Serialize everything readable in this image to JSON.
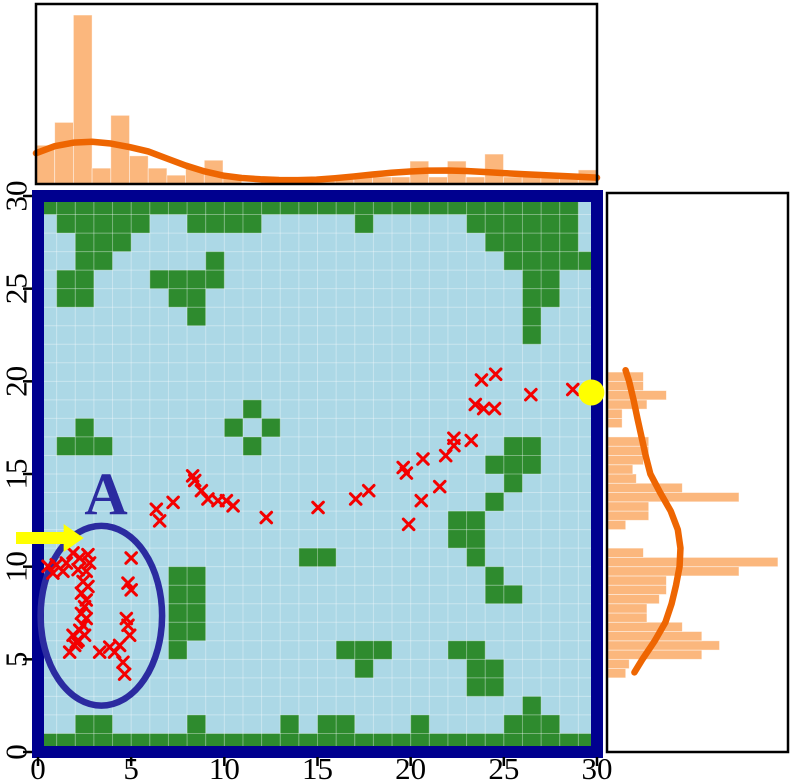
{
  "colors": {
    "background_free": "#ACD8E6",
    "obstacle_green": "#2E8B2E",
    "border_navy": "#00008F",
    "annotation_blue": "#2B2BA0",
    "trajectory_red": "#F40000",
    "start_goal_yellow": "#FFFF00",
    "hist_bar_orange": "#FBB77D",
    "kde_orange": "#EE6602",
    "frame_black": "#000000",
    "grid_seam": "rgba(255,255,255,0.35)",
    "tick_text": "#000000"
  },
  "main_plot": {
    "region_label": "A",
    "x_tick_values": [
      0,
      5,
      10,
      15,
      20,
      25,
      30
    ],
    "x_tick_labels": [
      "0",
      "5",
      "10",
      "15",
      "20",
      "25",
      "30"
    ],
    "y_tick_values": [
      0,
      5,
      10,
      15,
      20,
      25,
      30
    ],
    "y_tick_labels": [
      "0",
      "5",
      "10",
      "15",
      "20",
      "25",
      "30"
    ],
    "x_range": [
      0,
      30
    ],
    "y_range": [
      0,
      30
    ],
    "grid_size": 30
  },
  "chart_data": [
    {
      "id": "top_marginal_histogram",
      "type": "bar",
      "orientation": "vertical",
      "title": "",
      "xlabel": "",
      "ylabel": "",
      "xlim": [
        0,
        30
      ],
      "bin_start": 0,
      "bin_width": 1,
      "values_norm": [
        0.22,
        0.35,
        0.96,
        0.09,
        0.39,
        0.16,
        0.09,
        0.05,
        0.09,
        0.135,
        0.05,
        0.0,
        0.035,
        0.035,
        0.0,
        0.035,
        0.04,
        0.04,
        0.04,
        0.04,
        0.13,
        0.04,
        0.13,
        0.04,
        0.17,
        0.04,
        0.04,
        0.04,
        0.04,
        0.08
      ],
      "kde_x": [
        0,
        1,
        2,
        3,
        4,
        5,
        6,
        7,
        8,
        9,
        10,
        11,
        12,
        13,
        14,
        15,
        16,
        17,
        18,
        19,
        20,
        21,
        22,
        23,
        24,
        25,
        26,
        27,
        28,
        29,
        30
      ],
      "kde_y_norm": [
        0.175,
        0.215,
        0.235,
        0.24,
        0.23,
        0.21,
        0.185,
        0.145,
        0.105,
        0.072,
        0.048,
        0.034,
        0.027,
        0.023,
        0.022,
        0.025,
        0.033,
        0.043,
        0.054,
        0.064,
        0.071,
        0.076,
        0.077,
        0.074,
        0.068,
        0.062,
        0.056,
        0.051,
        0.046,
        0.041,
        0.036
      ]
    },
    {
      "id": "right_marginal_histogram",
      "type": "bar",
      "orientation": "horizontal",
      "title": "",
      "xlabel": "",
      "ylabel": "",
      "ylim": [
        0,
        30
      ],
      "bin_start": 4.0,
      "bin_width": 0.5,
      "values_norm": [
        0.1,
        0.12,
        0.53,
        0.63,
        0.53,
        0.42,
        0.22,
        0.22,
        0.29,
        0.33,
        0.33,
        0.74,
        0.96,
        0.2,
        0.0,
        0.0,
        0.1,
        0.23,
        0.23,
        0.74,
        0.42,
        0.16,
        0.14,
        0.2,
        0.23,
        0.23,
        0.0,
        0.08,
        0.08,
        0.22,
        0.33,
        0.2,
        0.2
      ],
      "kde_y": [
        20.6,
        20,
        19,
        18,
        17,
        16,
        15,
        14,
        13,
        12,
        11,
        10,
        9,
        8,
        7,
        6,
        5,
        4.3
      ],
      "kde_x_norm": [
        0.105,
        0.125,
        0.15,
        0.172,
        0.195,
        0.218,
        0.245,
        0.3,
        0.36,
        0.4,
        0.415,
        0.41,
        0.39,
        0.365,
        0.33,
        0.27,
        0.2,
        0.155
      ]
    },
    {
      "id": "occupancy_grid_scatter",
      "type": "scatter",
      "title": "",
      "xlim": [
        0,
        30
      ],
      "ylim": [
        0,
        30
      ],
      "grid": true,
      "obstacle_rows": [
        {
          "y": 0,
          "cols": [
            [
              0,
              29
            ]
          ]
        },
        {
          "y": 1,
          "cols": [
            [
              2,
              3
            ],
            [
              8,
              8
            ],
            [
              13,
              13
            ],
            [
              15,
              16
            ],
            [
              20,
              20
            ],
            [
              25,
              27
            ]
          ]
        },
        {
          "y": 2,
          "cols": [
            [
              26,
              26
            ]
          ]
        },
        {
          "y": 3,
          "cols": [
            [
              23,
              24
            ]
          ]
        },
        {
          "y": 4,
          "cols": [
            [
              17,
              17
            ],
            [
              23,
              24
            ]
          ]
        },
        {
          "y": 5,
          "cols": [
            [
              7,
              7
            ],
            [
              16,
              18
            ],
            [
              22,
              23
            ]
          ]
        },
        {
          "y": 6,
          "cols": [
            [
              7,
              8
            ]
          ]
        },
        {
          "y": 7,
          "cols": [
            [
              7,
              8
            ]
          ]
        },
        {
          "y": 8,
          "cols": [
            [
              7,
              8
            ],
            [
              24,
              25
            ]
          ]
        },
        {
          "y": 9,
          "cols": [
            [
              7,
              8
            ],
            [
              24,
              24
            ]
          ]
        },
        {
          "y": 10,
          "cols": [
            [
              14,
              15
            ],
            [
              23,
              23
            ]
          ]
        },
        {
          "y": 11,
          "cols": [
            [
              22,
              23
            ]
          ]
        },
        {
          "y": 12,
          "cols": [
            [
              22,
              23
            ]
          ]
        },
        {
          "y": 13,
          "cols": [
            [
              24,
              24
            ]
          ]
        },
        {
          "y": 14,
          "cols": [
            [
              25,
              25
            ]
          ]
        },
        {
          "y": 15,
          "cols": [
            [
              24,
              26
            ]
          ]
        },
        {
          "y": 16,
          "cols": [
            [
              1,
              3
            ],
            [
              11,
              11
            ],
            [
              25,
              26
            ]
          ]
        },
        {
          "y": 17,
          "cols": [
            [
              2,
              2
            ],
            [
              10,
              10
            ],
            [
              12,
              12
            ]
          ]
        },
        {
          "y": 18,
          "cols": [
            [
              11,
              11
            ]
          ]
        },
        {
          "y": 22,
          "cols": [
            [
              26,
              26
            ]
          ]
        },
        {
          "y": 23,
          "cols": [
            [
              8,
              8
            ],
            [
              26,
              26
            ]
          ]
        },
        {
          "y": 24,
          "cols": [
            [
              1,
              2
            ],
            [
              7,
              8
            ],
            [
              26,
              27
            ]
          ]
        },
        {
          "y": 25,
          "cols": [
            [
              1,
              2
            ],
            [
              6,
              9
            ],
            [
              26,
              27
            ]
          ]
        },
        {
          "y": 26,
          "cols": [
            [
              2,
              3
            ],
            [
              9,
              9
            ],
            [
              25,
              29
            ]
          ]
        },
        {
          "y": 27,
          "cols": [
            [
              2,
              4
            ],
            [
              24,
              28
            ]
          ]
        },
        {
          "y": 28,
          "cols": [
            [
              1,
              5
            ],
            [
              8,
              11
            ],
            [
              17,
              17
            ],
            [
              23,
              28
            ]
          ]
        },
        {
          "y": 29,
          "cols": [
            [
              0,
              28
            ]
          ]
        }
      ],
      "trajectory_points": [
        [
          0.54,
          10.02
        ],
        [
          0.8,
          9.65
        ],
        [
          0.98,
          10.1
        ],
        [
          1.34,
          9.75
        ],
        [
          1.52,
          10.2
        ],
        [
          1.7,
          5.39
        ],
        [
          1.88,
          10.74
        ],
        [
          1.88,
          6.3
        ],
        [
          1.97,
          5.75
        ],
        [
          2.06,
          5.93
        ],
        [
          2.15,
          9.84
        ],
        [
          2.15,
          6.02
        ],
        [
          2.24,
          10.47
        ],
        [
          2.24,
          6.57
        ],
        [
          2.33,
          8.57
        ],
        [
          2.33,
          7.48
        ],
        [
          2.42,
          9.2
        ],
        [
          2.42,
          6.84
        ],
        [
          2.5,
          7.84
        ],
        [
          2.5,
          6.3
        ],
        [
          2.59,
          9.75
        ],
        [
          2.59,
          8.2
        ],
        [
          2.59,
          7.2
        ],
        [
          2.68,
          10.65
        ],
        [
          2.68,
          8.93
        ],
        [
          2.77,
          10.2
        ],
        [
          3.31,
          5.39
        ],
        [
          3.85,
          5.66
        ],
        [
          4.11,
          5.39
        ],
        [
          4.38,
          5.75
        ],
        [
          4.56,
          4.84
        ],
        [
          4.65,
          4.2
        ],
        [
          4.74,
          7.2
        ],
        [
          4.83,
          9.11
        ],
        [
          4.83,
          6.84
        ],
        [
          4.92,
          6.3
        ],
        [
          5.0,
          10.47
        ],
        [
          5.0,
          8.75
        ],
        [
          6.35,
          13.1
        ],
        [
          6.53,
          12.47
        ],
        [
          7.25,
          13.47
        ],
        [
          8.3,
          14.9
        ],
        [
          8.41,
          14.65
        ],
        [
          8.77,
          14.1
        ],
        [
          9.12,
          13.65
        ],
        [
          9.66,
          13.56
        ],
        [
          10.11,
          13.56
        ],
        [
          10.47,
          13.28
        ],
        [
          12.25,
          12.65
        ],
        [
          15.03,
          13.19
        ],
        [
          17.05,
          13.65
        ],
        [
          17.75,
          14.1
        ],
        [
          19.6,
          15.35
        ],
        [
          19.77,
          15.05
        ],
        [
          19.89,
          12.28
        ],
        [
          20.57,
          13.56
        ],
        [
          20.66,
          15.81
        ],
        [
          21.56,
          14.32
        ],
        [
          21.88,
          15.99
        ],
        [
          22.32,
          16.93
        ],
        [
          22.32,
          16.53
        ],
        [
          23.25,
          16.81
        ],
        [
          23.47,
          18.75
        ],
        [
          23.92,
          18.53
        ],
        [
          24.5,
          18.53
        ],
        [
          23.8,
          20.07
        ],
        [
          24.56,
          20.38
        ],
        [
          26.45,
          19.28
        ],
        [
          28.7,
          19.56
        ]
      ],
      "goal_point": [
        29.7,
        19.4
      ],
      "region_ellipse": {
        "cx": 3.4,
        "cy": 7.35,
        "rx": 3.26,
        "ry": 4.85
      },
      "start_arrow": {
        "tip": [
          2.45,
          11.55
        ],
        "tail_px_x": 16
      }
    }
  ]
}
